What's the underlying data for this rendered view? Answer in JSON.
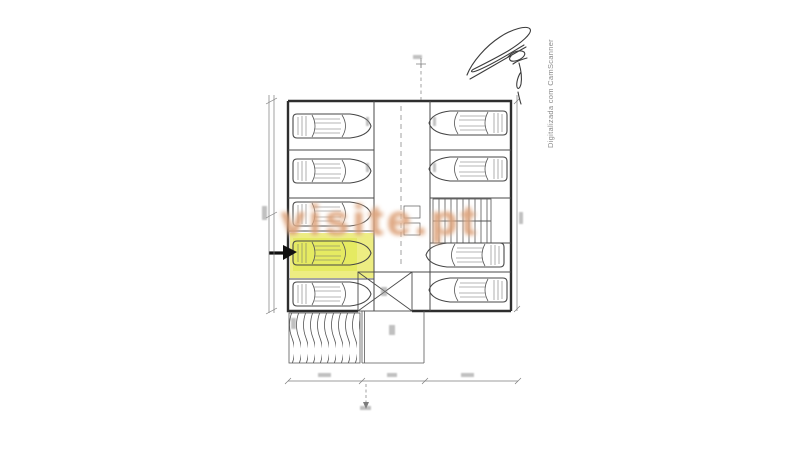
{
  "document": {
    "kind": "scanned architectural drawing",
    "subject": "underground parking floor plan",
    "background_hex": "#ffffff",
    "line_color_hex": "#3c3c3c"
  },
  "watermark": {
    "text": "visite.pt",
    "color_hex": "#c66c32"
  },
  "scan_attribution": {
    "text": "Digitalizada com CamScanner",
    "color_hex": "#8a8a8a"
  },
  "floor_plan": {
    "left_column_stall_count": 5,
    "right_column_stall_count": 4,
    "car_count": 9,
    "highlighted_stall": {
      "column": "left",
      "row_from_top": 4,
      "highlight_color_hex": "#e9e96f",
      "marker": "black-arrow-pointing-right"
    },
    "features": [
      "central driving aisle with dashed centerline",
      "staircase core",
      "entrance gate with cross bracing",
      "hatched access ramp",
      "dimension lines with illegible small figures",
      "handwritten signature top right"
    ]
  }
}
